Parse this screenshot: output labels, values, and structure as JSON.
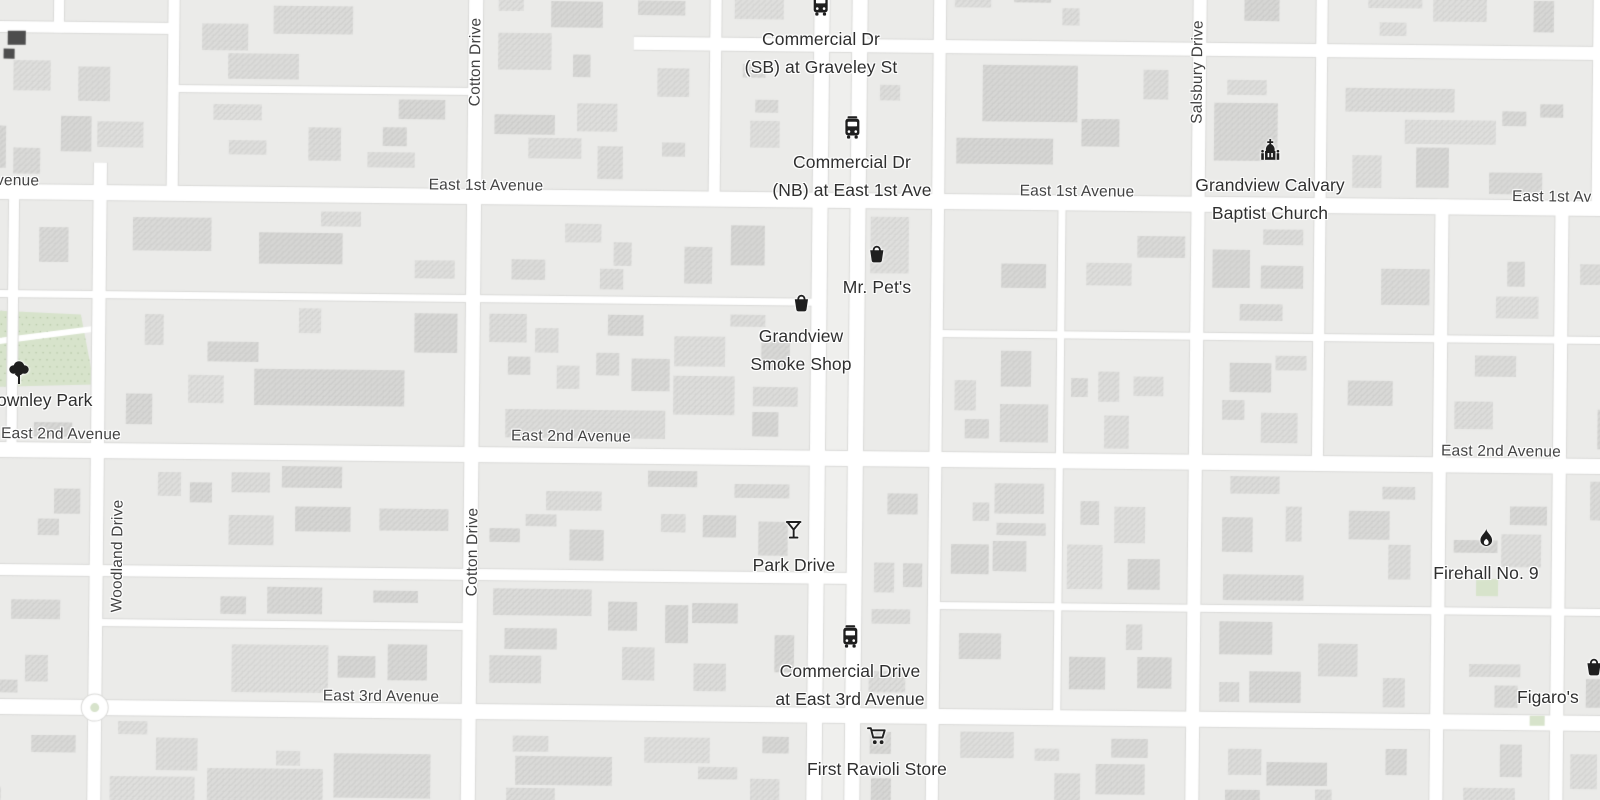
{
  "map_type": "street-map",
  "colors": {
    "background": "#ebebe9",
    "road": "#ffffff",
    "road_casing": "#dadad8",
    "median": "#efefed",
    "building_hatch": "rgba(100,100,100,0.10)",
    "park": "#d7e3cb",
    "park_dot": "rgba(120,150,100,0.35)",
    "dark_building": "#4d4d4d",
    "street_label": "#424242",
    "poi_label": "#2f2f2f",
    "poi_icon": "#1f1f1f"
  },
  "street_labels": {
    "east1_left_partial": "venue",
    "east1_mid": "East 1st Avenue",
    "east1_right": "East 1st Avenue",
    "east1_right_edge": "East 1st Av",
    "east2_left": "East 2nd Avenue",
    "east2_mid": "East 2nd Avenue",
    "east2_right": "East 2nd Avenue",
    "east3": "East 3rd Avenue",
    "cotton_top": "Cotton Drive",
    "cotton_mid": "Cotton Drive",
    "woodland": "Woodland Drive",
    "salsbury": "Salsbury Drive"
  },
  "pois": {
    "bus_stop_graveley": {
      "line1": "Commercial Dr",
      "line2": "(SB) at Graveley St",
      "icon": "bus-icon"
    },
    "bus_stop_east1": {
      "line1": "Commercial Dr",
      "line2": "(NB) at East 1st Ave",
      "icon": "bus-icon"
    },
    "church": {
      "line1": "Grandview Calvary",
      "line2": "Baptist Church",
      "icon": "church-icon"
    },
    "mr_pets": {
      "line1": "Mr. Pet's",
      "icon": "shopping-basket-icon"
    },
    "smoke_shop": {
      "line1": "Grandview",
      "line2": "Smoke Shop",
      "icon": "shopping-basket-icon"
    },
    "park": {
      "line1": "ownley Park",
      "icon": "tree-icon"
    },
    "park_drive_bar": {
      "line1": "Park Drive",
      "icon": "cocktail-icon"
    },
    "firehall": {
      "line1": "Firehall No. 9",
      "icon": "flame-icon"
    },
    "bus_stop_east3": {
      "line1": "Commercial Drive",
      "line2": "at East 3rd Avenue",
      "icon": "bus-icon"
    },
    "ravioli": {
      "line1": "First Ravioli Store",
      "icon": "shopping-cart-icon"
    },
    "figaros": {
      "line1": "Figaro's",
      "icon": "shopping-basket-icon"
    }
  }
}
